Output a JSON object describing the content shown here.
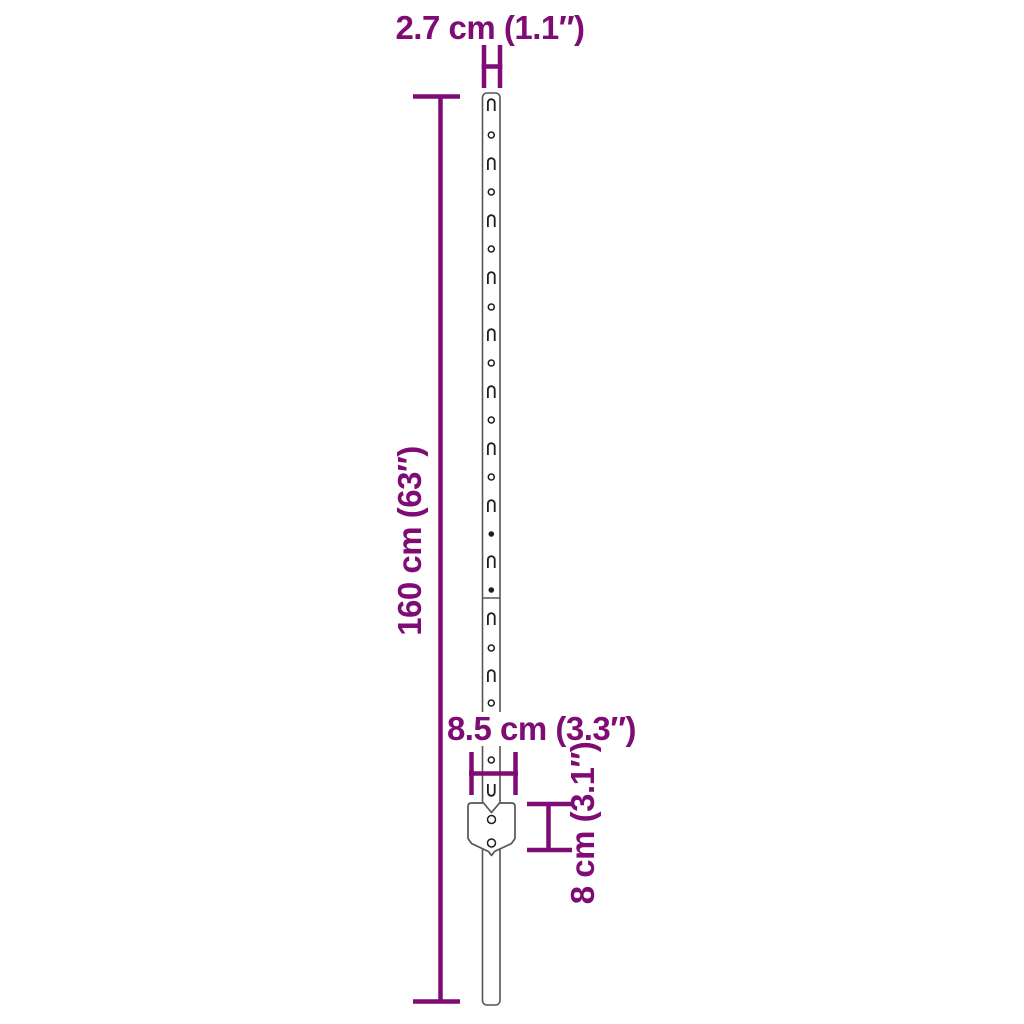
{
  "diagram": {
    "title": "U-post dimension diagram",
    "colors": {
      "dimension": "#7F0C74",
      "outline": "#555555",
      "hole": "#1d1d1d",
      "background": "#ffffff"
    },
    "labels": {
      "top_width": "2.7 cm (1.1″)",
      "height": "160 cm (63″)",
      "plate_width": "8.5 cm (3.3″)",
      "plate_height": "8 cm (3.1″)"
    }
  }
}
